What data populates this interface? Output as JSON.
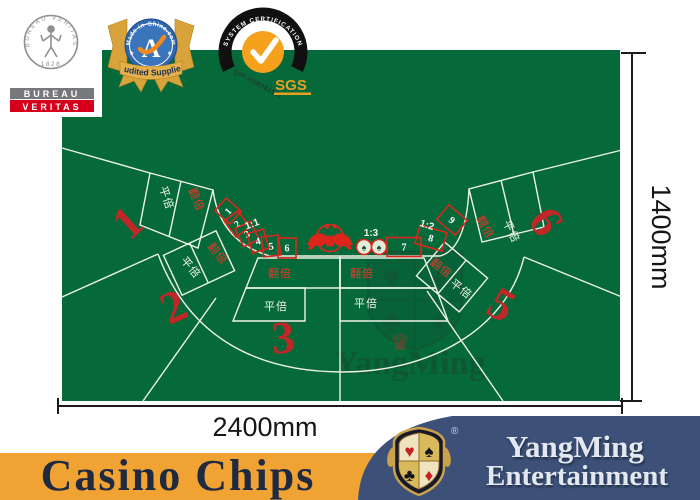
{
  "badges": {
    "bureau_veritas": {
      "arc_text": "BUREAU VERITAS",
      "year": "1828",
      "line1": "BUREAU",
      "line2": "VERITAS"
    },
    "made_in_china": {
      "arc_text": "Made-in-China.com",
      "letter": "A",
      "banner": "Audited Supplier"
    },
    "sgs": {
      "arc_text": "SYSTEM CERTIFICATION",
      "code": "QIP-ASR181511",
      "brand": "SGS"
    }
  },
  "dimensions": {
    "width": "2400mm",
    "height": "1400mm"
  },
  "felt": {
    "felt_color": "#05693A",
    "line_color": "#EEF3E8",
    "red_color": "#DC261B",
    "seat_numbers": [
      "1",
      "2",
      "3",
      "5",
      "6"
    ],
    "bet_double": "翻倍",
    "bet_flat": "平倍",
    "card_boxes_left": [
      "1",
      "2",
      "3",
      "4",
      "5",
      "6"
    ],
    "card_boxes_right": [
      "7",
      "8",
      "9"
    ],
    "odds_left": "1:1",
    "odds_right": "1:2",
    "odds_banker": "1:3",
    "banker_suit": "♠"
  },
  "watermark": {
    "text": "YangMing",
    "suits": [
      "♥",
      "♠",
      "♣",
      "♦"
    ],
    "crown": "♛"
  },
  "footer": {
    "left_text": "Casino Chips",
    "brand_line1": "YangMing",
    "brand_line2": "Entertainment",
    "registered": "®",
    "logo_suits": [
      "♥",
      "♠",
      "♣",
      "♦"
    ],
    "orange_color": "#F0A233",
    "navy_color": "#3D5178"
  }
}
